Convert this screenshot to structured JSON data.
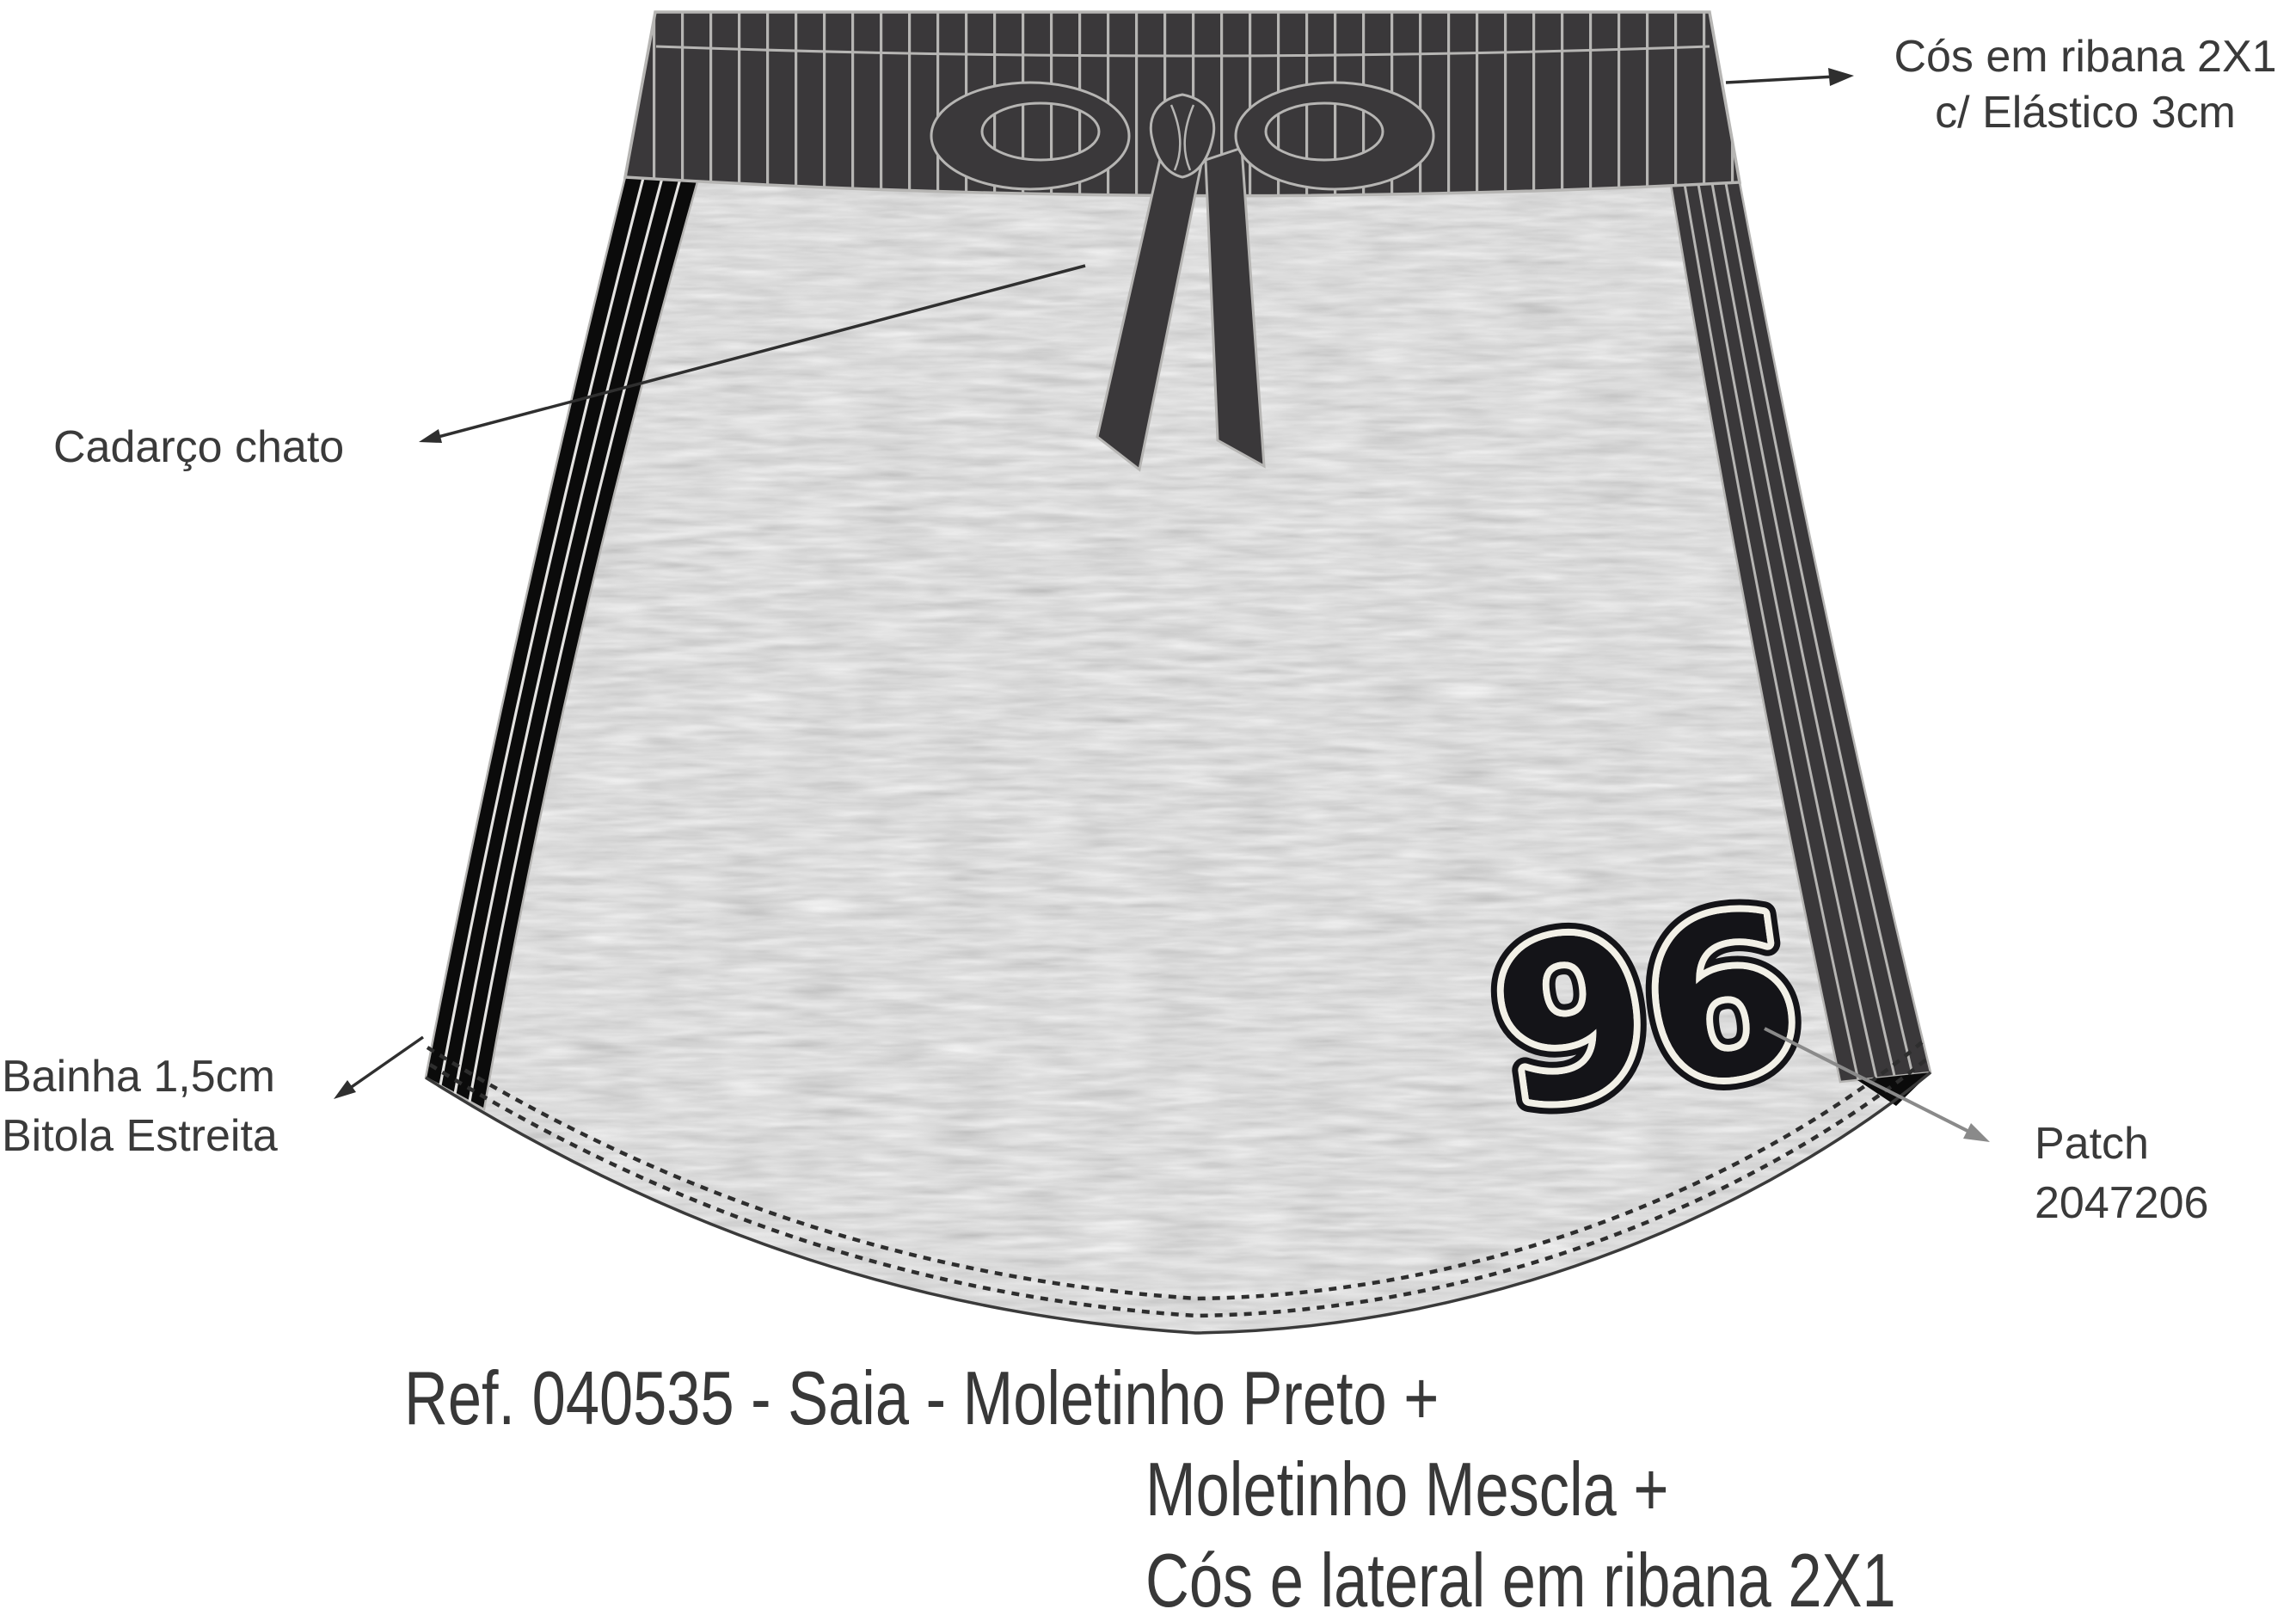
{
  "annotations": {
    "waistband": {
      "line1": "Cós em ribana 2X1",
      "line2": "c/ Elástico 3cm"
    },
    "drawstring": {
      "label": "Cadarço chato"
    },
    "hem": {
      "line1": "Bainha 1,5cm",
      "line2": "Bitola Estreita"
    },
    "patch_note": {
      "line1": "Patch",
      "line2": "2047206"
    }
  },
  "patch": {
    "number": "96"
  },
  "caption": {
    "line1": "Ref. 040535 - Saia - Moletinho Preto +",
    "line2": "Moletinho Mescla +",
    "line3": "Cós e lateral em ribana 2X1"
  },
  "colors": {
    "rib_dark": "#3a383a",
    "rib_line": "#b6b5b3",
    "stripe_black": "#0b0b0b",
    "heather_gray": "#b4b4b4",
    "stitch": "#2e2e2e",
    "text": "#3a3a3a",
    "patch_outline": "#f2f0e7",
    "patch_fill": "#141418",
    "patch_arrow": "#8a8a8a"
  }
}
